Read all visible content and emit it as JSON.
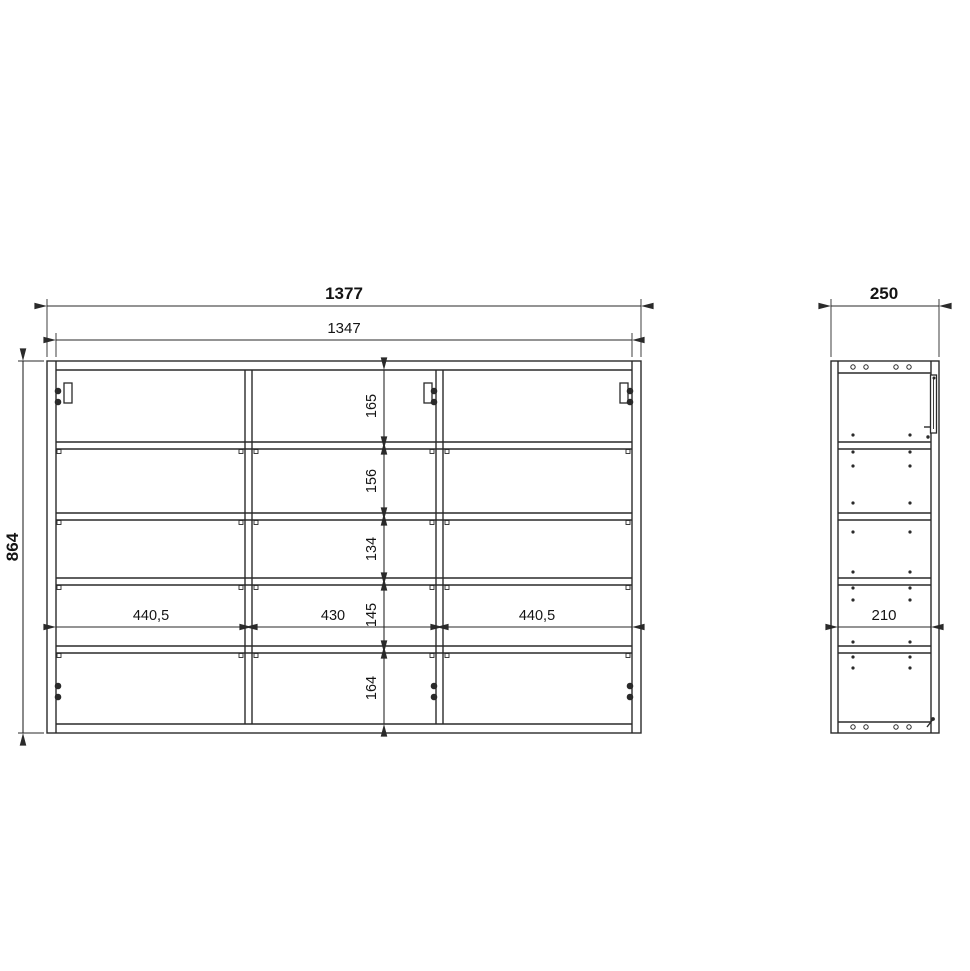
{
  "colors": {
    "background": "#ffffff",
    "line": "#2a2a2a",
    "text": "#141414"
  },
  "drawing": {
    "type": "furniture-technical-drawing",
    "front_view": {
      "overall_width": "1377",
      "inner_width": "1347",
      "overall_height": "864",
      "shelf_spacings": [
        "165",
        "156",
        "134",
        "145",
        "164"
      ],
      "compartment_widths": [
        "440,5",
        "430",
        "440,5"
      ]
    },
    "side_view": {
      "overall_depth": "250",
      "inner_depth": "210"
    }
  }
}
